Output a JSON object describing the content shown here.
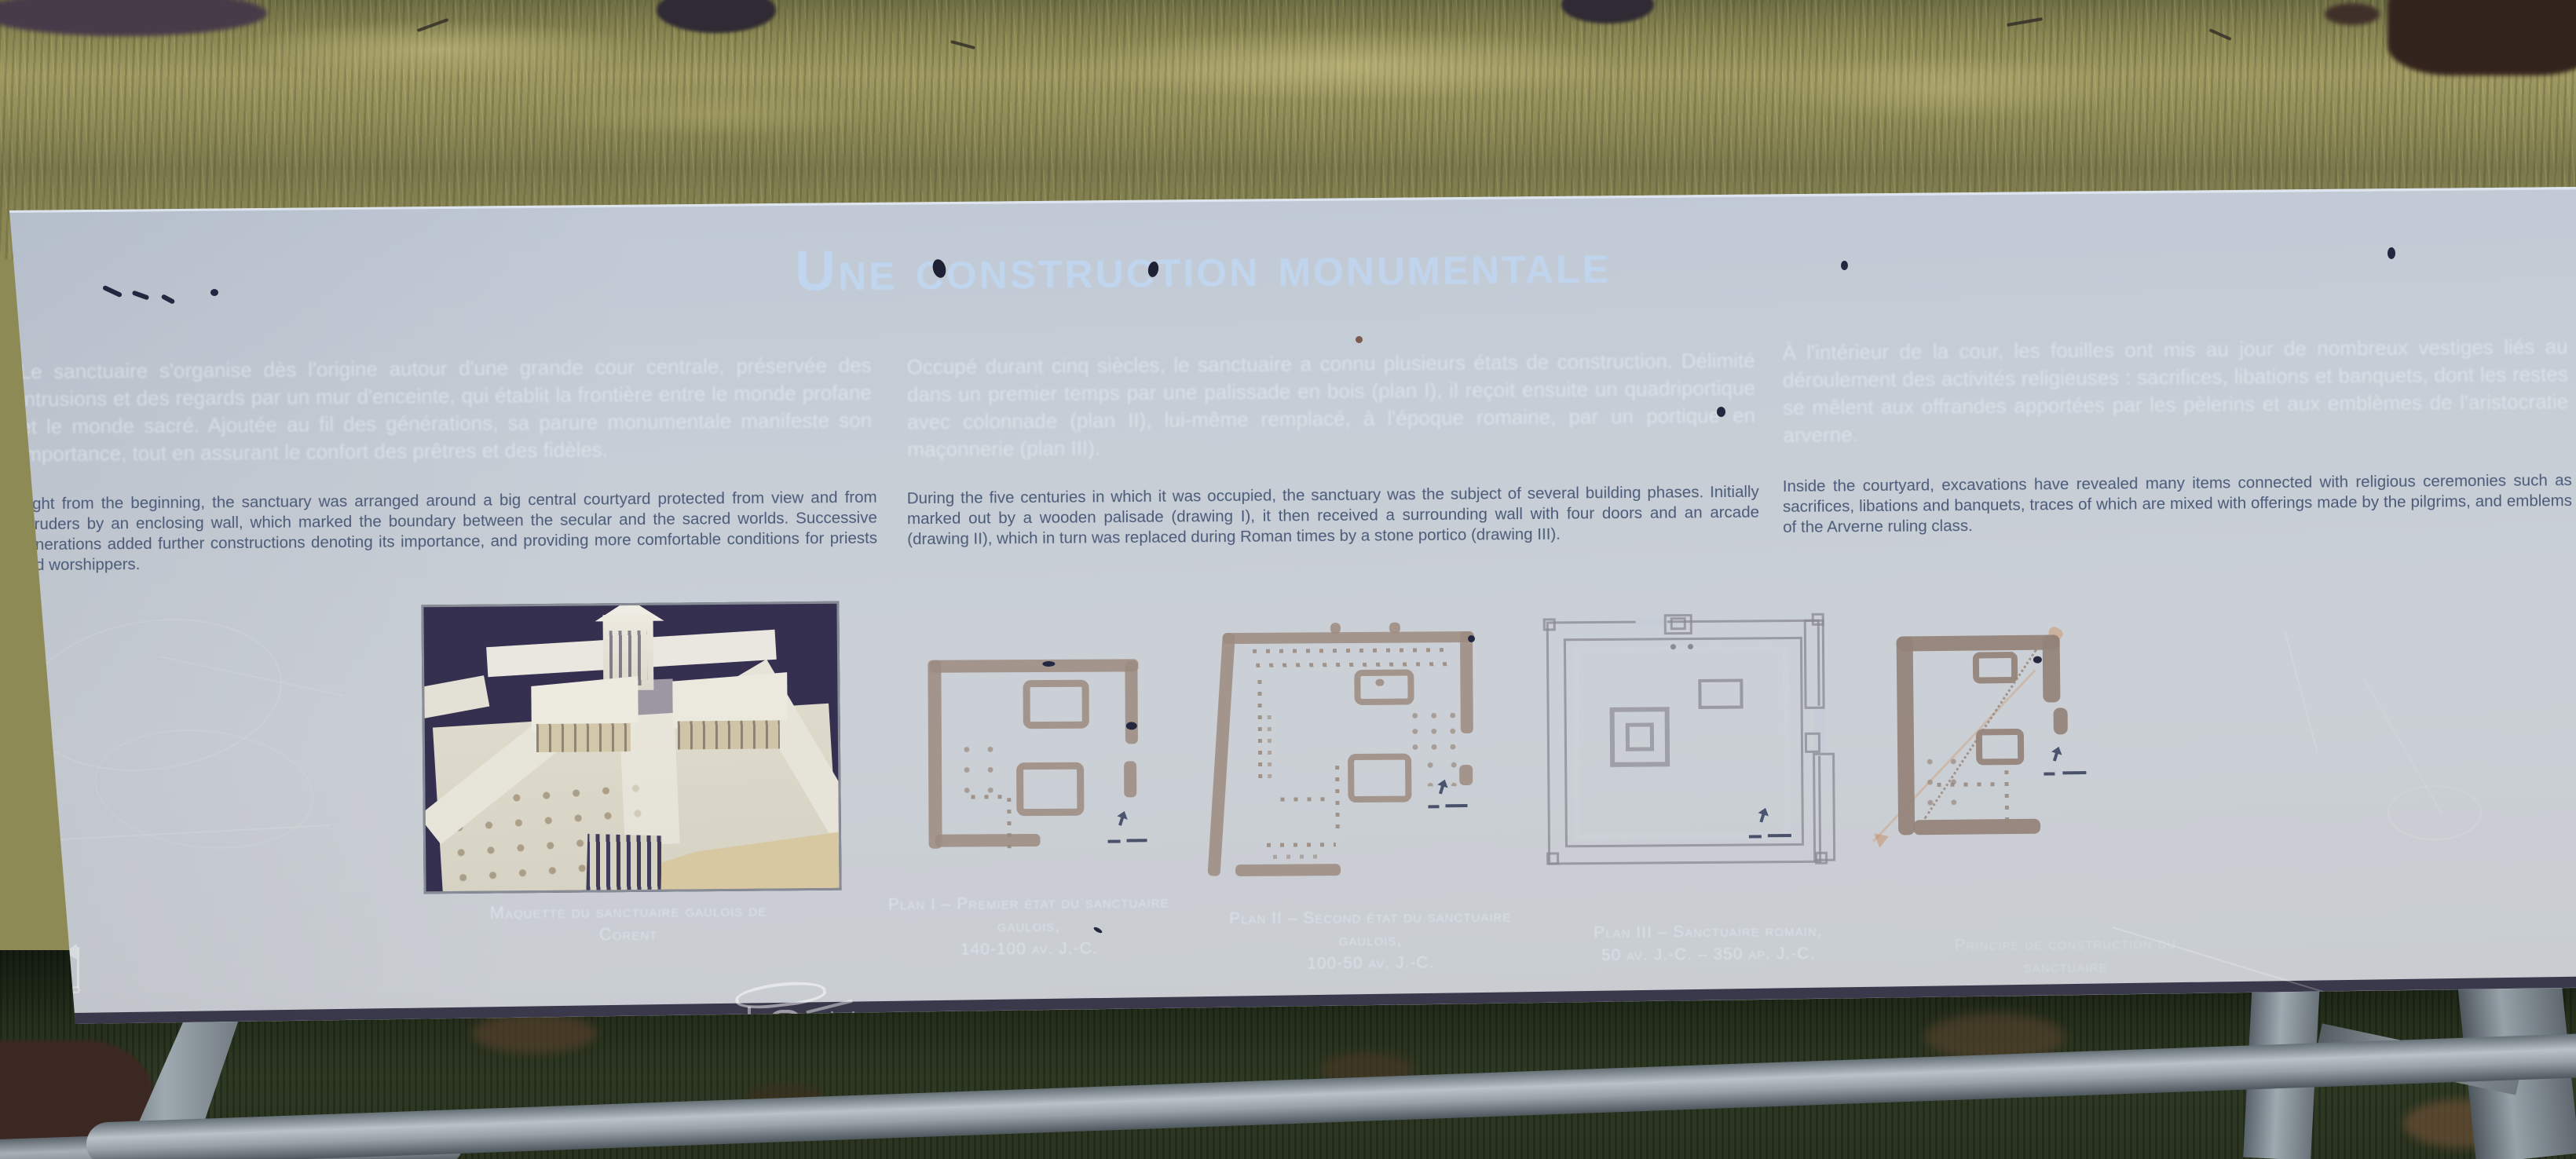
{
  "panel": {
    "title": "Une construction monumentale",
    "columns": [
      {
        "fr": "Le sanctuaire s'organise dès l'origine autour d'une grande cour centrale, préservée des intrusions et des regards par un mur d'enceinte, qui établit la frontière entre le monde profane et le monde sacré. Ajoutée au fil des générations, sa parure monumentale manifeste son importance, tout en assurant le confort des prêtres et des fidèles.",
        "en": "Right from the beginning, the sanctuary was arranged around a big central courtyard protected from view and from intruders by an enclosing wall, which marked the boundary between the secular and the sacred worlds. Successive generations added further constructions denoting its importance, and providing more comfortable conditions for priests and worshippers."
      },
      {
        "fr": "Occupé durant cinq siècles, le sanctuaire a connu plusieurs états de construction. Délimité dans un premier temps par une palissade en bois (plan I), il reçoit ensuite un quadriportique avec colonnade (plan II), lui-même remplacé, à l'époque romaine, par un portique en maçonnerie (plan III).",
        "en": "During the five centuries in which it was occupied, the sanctuary was the subject of several building phases. Initially marked out by a wooden palisade (drawing I), it then received a surrounding wall with four doors and an arcade (drawing II), which in turn was replaced during Roman times by a stone portico (drawing III)."
      },
      {
        "fr": "À l'intérieur de la cour, les fouilles ont mis au jour de nombreux vestiges liés au déroulement des activités religieuses : sacrifices, libations et banquets, dont les restes se mêlent aux offrandes apportées par les pèlerins et aux emblèmes de l'aristocratie arverne.",
        "en": "Inside the courtyard, excavations have revealed many items connected with religious ceremonies such as sacrifices, libations and banquets, traces of which are mixed with offerings made by the pilgrims, and emblems of the Arverne ruling class."
      }
    ],
    "figures": {
      "photo_caption": "Maquette du sanctuaire gaulois de Corent",
      "plans": [
        {
          "caption": "Plan I – Premier état du sanctuaire gaulois,",
          "dates": "140-100 av. J.-C."
        },
        {
          "caption": "Plan II – Second état du sanctuaire gaulois,",
          "dates": "100-50 av. J.-C."
        },
        {
          "caption": "Plan III – Sanctuaire romain,",
          "dates": "50 av. J.-C. – 350 ap. J.-C."
        },
        {
          "caption": "Principe de construction du sanctuaire",
          "dates": ""
        }
      ]
    },
    "colors": {
      "panel": "#c6cdd6",
      "title": "#c0d6f0",
      "english_text": "#4a5a78",
      "french_text": "#f3f8fe",
      "plan_walls": "#9c8b7f",
      "photo_background": "#353050"
    }
  }
}
